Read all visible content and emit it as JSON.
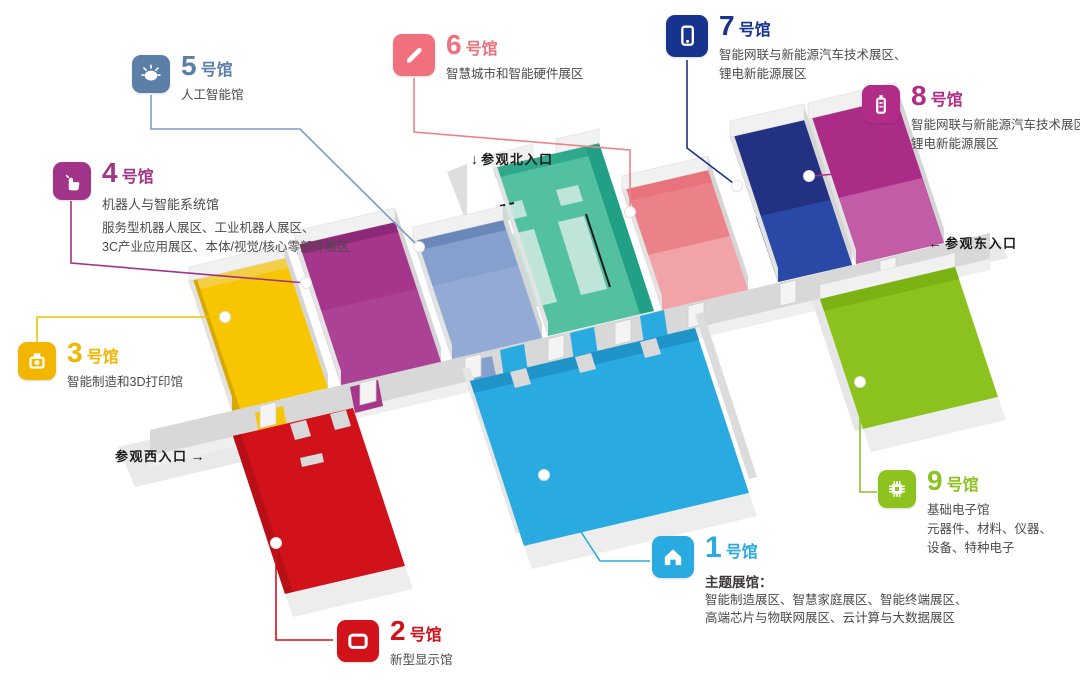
{
  "title": "展馆分布图",
  "halls": [
    {
      "number": "1",
      "suffix": "号馆",
      "color": "#29ABE2",
      "floor_color": "#29ABE2",
      "icon": "home-icon",
      "subtitle_bold": "主题展馆：",
      "desc": [
        "智能制造展区、智慧家庭展区、智能终端展区、",
        "高端芯片与物联网展区、云计算与大数据展区"
      ]
    },
    {
      "number": "2",
      "suffix": "号馆",
      "color": "#D2121B",
      "floor_color": "#D2121B",
      "icon": "display-icon",
      "desc": [
        "新型显示馆"
      ]
    },
    {
      "number": "3",
      "suffix": "号馆",
      "color": "#F2B600",
      "floor_color": "#F7C600",
      "icon": "printer-3d-icon",
      "desc": [
        "智能制造和3D打印馆"
      ]
    },
    {
      "number": "4",
      "suffix": "号馆",
      "color": "#A13389",
      "floor_color": "#A6368B",
      "icon": "hand-pointer-icon",
      "name": "机器人与智能系统馆",
      "desc": [
        "服务型机器人展区、工业机器人展区、",
        "3C产业应用展区、本体/视觉/核心零部件展区"
      ]
    },
    {
      "number": "5",
      "suffix": "号馆",
      "color": "#5C7FA8",
      "floor_color": "#86A0CD",
      "icon": "brain-icon",
      "desc": [
        "人工智能馆"
      ]
    },
    {
      "number": "6",
      "suffix": "号馆",
      "color": "#F0717D",
      "floor_color": "#EC8289",
      "icon": "pen-icon",
      "desc": [
        "智慧城市和智能硬件展区"
      ]
    },
    {
      "number": "7",
      "suffix": "号馆",
      "color": "#16338E",
      "floor_color": "#233183",
      "icon": "phone-icon",
      "desc": [
        "智能网联与新能源汽车技术展区、",
        "锂电新能源展区"
      ]
    },
    {
      "number": "8",
      "suffix": "号馆",
      "color": "#B02C87",
      "floor_color": "#AB2C87",
      "icon": "battery-icon",
      "desc": [
        "智能网联与新能源汽车技术展区",
        "锂电新能源展区"
      ]
    },
    {
      "number": "9",
      "suffix": "号馆",
      "color": "#8DC21F",
      "floor_color": "#8CC21E",
      "icon": "chip-icon",
      "desc": [
        "基础电子馆",
        "元器件、材料、仪器、",
        "设备、特种电子"
      ]
    }
  ],
  "entrance_hall": {
    "floor_color": "#53C0A2",
    "booth_color": "#BFE5D9"
  },
  "entrances": {
    "north": {
      "arrow": "↓",
      "label": "参观北入口"
    },
    "east": {
      "arrow": "←",
      "label": "参观东入口"
    },
    "west": {
      "label": "参观西入口",
      "arrow": "→"
    }
  }
}
